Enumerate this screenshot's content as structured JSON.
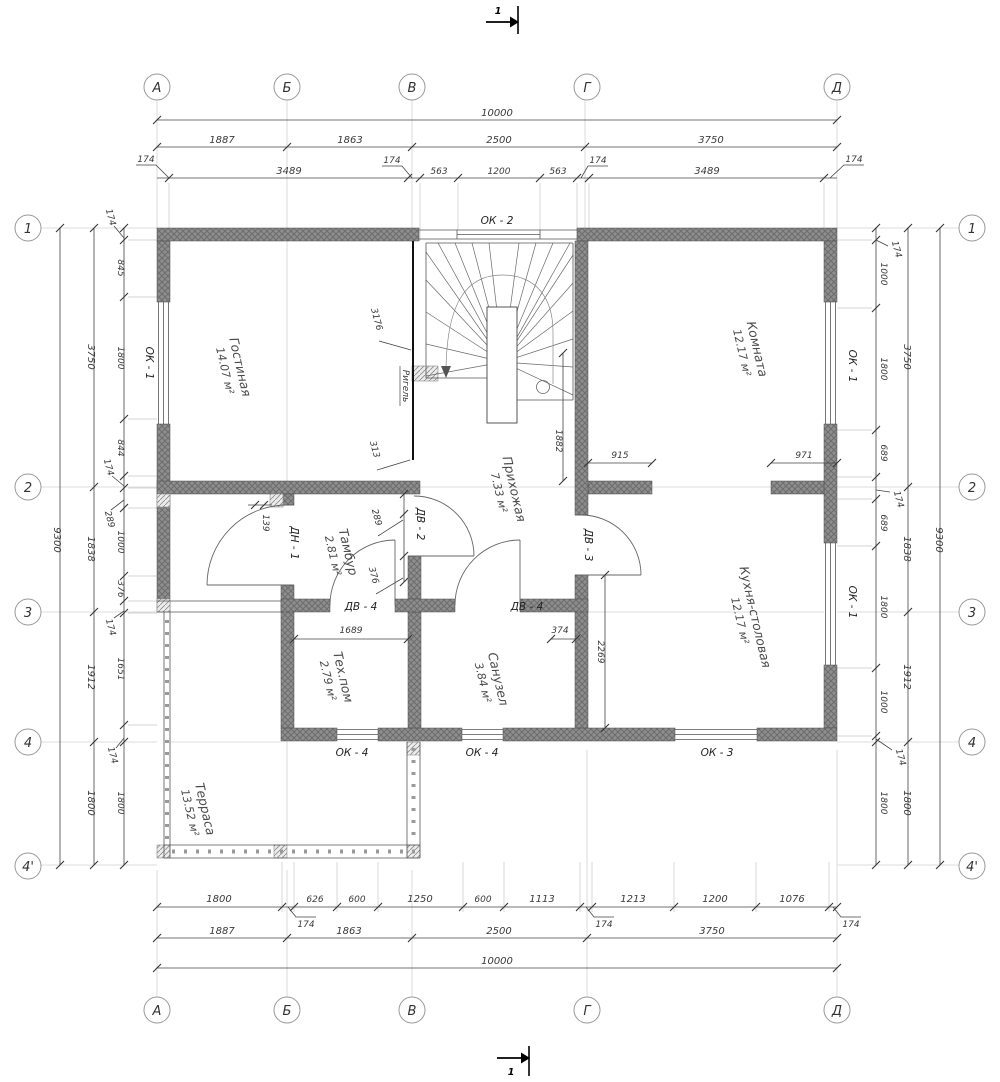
{
  "axes": {
    "cols": [
      "А",
      "Б",
      "В",
      "Г",
      "Д"
    ],
    "rows": [
      "1",
      "2",
      "3",
      "4",
      "4'"
    ]
  },
  "section": "1",
  "beam": "Ригель",
  "rooms": [
    {
      "name": "Гостиная",
      "area": "14.07 м²"
    },
    {
      "name": "Комната",
      "area": "12.17 м²"
    },
    {
      "name": "Прихожая",
      "area": "7.33 м²"
    },
    {
      "name": "Тамбур",
      "area": "2.81 м²"
    },
    {
      "name": "Тех.пом",
      "area": "2.79 м²"
    },
    {
      "name": "Санузел",
      "area": "3.84 м²"
    },
    {
      "name": "Кухня-столовая",
      "area": "12.17 м²"
    },
    {
      "name": "Терраса",
      "area": "13.52 м²"
    }
  ],
  "openings": {
    "ok1": "ОК - 1",
    "ok2": "ОК - 2",
    "ok3": "ОК - 3",
    "ok4": "ОК - 4",
    "dv2": "ДВ - 2",
    "dv3": "ДВ - 3",
    "dv4": "ДВ - 4",
    "dn1": "ДН - 1"
  },
  "dims": {
    "total": "10000",
    "spans": [
      "1887",
      "1863",
      "2500",
      "3750"
    ],
    "top_inner": [
      "3489",
      "563",
      "1200",
      "563",
      "3489"
    ],
    "d174": "174",
    "side_outer": "9300",
    "side_mid": [
      "3750",
      "1838",
      "1912",
      "1800"
    ],
    "left_inner": [
      "845",
      "1800",
      "844",
      "289",
      "1000",
      "376",
      "1651",
      "1800"
    ],
    "right_inner": [
      "1000",
      "1800",
      "689",
      "689",
      "1800",
      "1000",
      "1800"
    ],
    "bottom_inner": [
      "1800",
      "626",
      "600",
      "1250",
      "600",
      "1113",
      "1213",
      "1200",
      "1076"
    ],
    "hall_height": "1882",
    "opening_left": "915",
    "opening_right": "971",
    "kitchen_height": "2269",
    "san_offset": "374",
    "teh_width": "1689",
    "beam_len": "3176",
    "beam_off": "313",
    "tam_off1": "289",
    "tam_off2": "376",
    "door_off": "139"
  }
}
